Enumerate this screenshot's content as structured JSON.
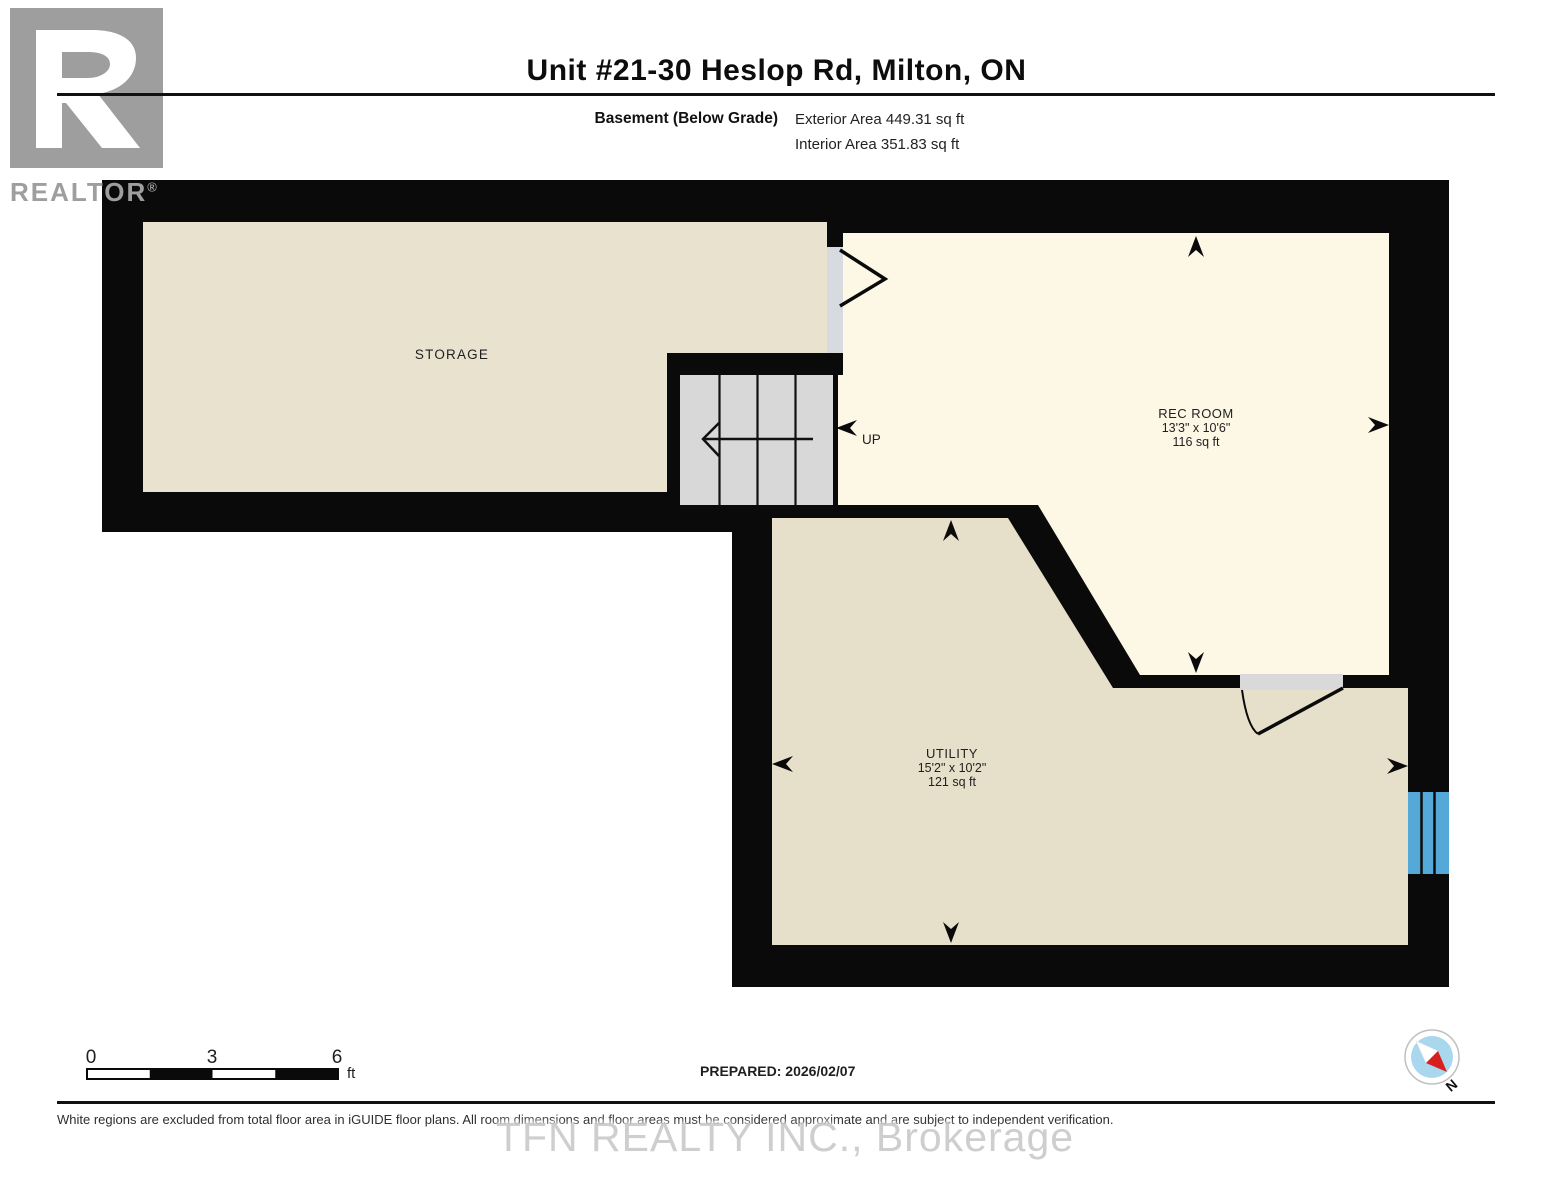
{
  "header": {
    "title": "Unit #21-30 Heslop Rd, Milton, ON",
    "floor_label": "Basement (Below Grade)",
    "exterior_area": "Exterior Area 449.31 sq ft",
    "interior_area": "Interior Area 351.83 sq ft"
  },
  "logo": {
    "brand": "REALTOR",
    "registered": "®"
  },
  "rooms": {
    "storage": {
      "name": "STORAGE"
    },
    "rec": {
      "name": "REC ROOM",
      "dimensions": "13'3\" x 10'6\"",
      "area": "116 sq ft"
    },
    "utility": {
      "name": "UTILITY",
      "dimensions": "15'2\" x 10'2\"",
      "area": "121 sq ft"
    }
  },
  "stairs": {
    "direction_label": "UP"
  },
  "scale_bar": {
    "tick0": "0",
    "tick1": "3",
    "tick2": "6",
    "unit": "ft"
  },
  "footer": {
    "prepared": "PREPARED: 2026/02/07",
    "compass_label": "N",
    "disclaimer": "White regions are excluded from total floor area in iGUIDE floor plans. All room dimensions and floor areas must be considered approximate and are subject to independent verification.",
    "watermark": "TFN REALTY INC., Brokerage"
  },
  "colors": {
    "wall": "#0a0a0a",
    "storage_fill": "#e9e2ce",
    "utility_fill": "#e6dfc9",
    "rec_fill": "#fdf8e6",
    "stair_tread": "#d8d8d8",
    "door_gap": "#d7dbe0",
    "window_blue": "#54a9d9",
    "compass_blue": "#a9d7ee",
    "compass_red": "#d81e1e"
  }
}
